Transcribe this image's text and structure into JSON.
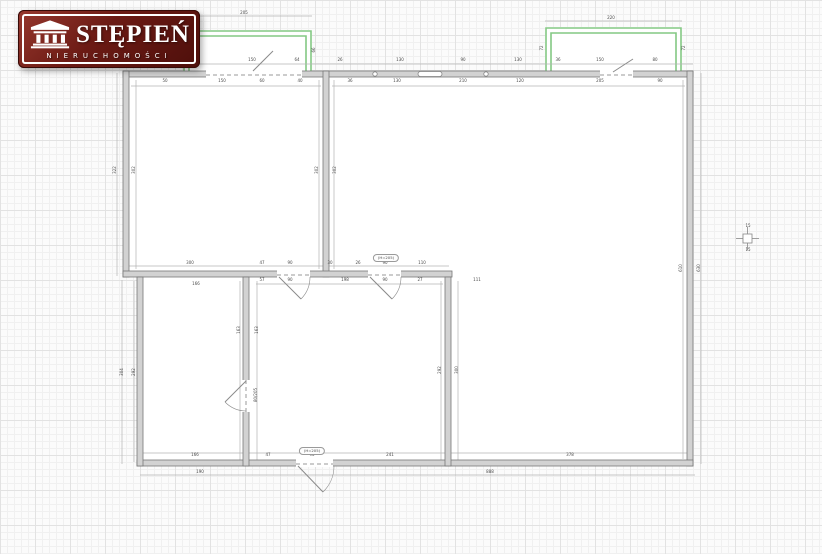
{
  "logo": {
    "title": "STĘPIEŃ",
    "subtitle": "NIERUCHOMOŚCI",
    "bg_color": "#6b1a14",
    "frame_color": "#ffffff",
    "icon": "portico-columns-icon"
  },
  "plan": {
    "wall_fill": "#d2d2d2",
    "wall_edge": "#777777",
    "balcony_color": "#84c884",
    "dim_line_color": "#b4b4b4",
    "annotations": [
      {
        "t": "(H=205)",
        "x": 386,
        "y": 258
      },
      {
        "t": "(H=205)",
        "x": 312,
        "y": 451
      }
    ],
    "door_labels": [
      {
        "t": "80/205",
        "x": 256,
        "y": 395
      }
    ],
    "dimension_labels": [
      {
        "t": "205",
        "x": 244,
        "y": 13
      },
      {
        "t": "66",
        "x": 179,
        "y": 50,
        "r": 1
      },
      {
        "t": "66",
        "x": 314,
        "y": 50,
        "r": 1
      },
      {
        "t": "220",
        "x": 611,
        "y": 18
      },
      {
        "t": "72",
        "x": 542,
        "y": 48,
        "r": 1
      },
      {
        "t": "72",
        "x": 684,
        "y": 48,
        "r": 1
      },
      {
        "t": "46",
        "x": 151,
        "y": 60
      },
      {
        "t": "30",
        "x": 196,
        "y": 60
      },
      {
        "t": "150",
        "x": 252,
        "y": 60
      },
      {
        "t": "64",
        "x": 297,
        "y": 60
      },
      {
        "t": "26",
        "x": 340,
        "y": 60
      },
      {
        "t": "130",
        "x": 400,
        "y": 60
      },
      {
        "t": "90",
        "x": 463,
        "y": 60
      },
      {
        "t": "130",
        "x": 518,
        "y": 60
      },
      {
        "t": "36",
        "x": 558,
        "y": 60
      },
      {
        "t": "150",
        "x": 600,
        "y": 60
      },
      {
        "t": "80",
        "x": 655,
        "y": 60
      },
      {
        "t": "50",
        "x": 165,
        "y": 81
      },
      {
        "t": "150",
        "x": 222,
        "y": 81
      },
      {
        "t": "60",
        "x": 262,
        "y": 81
      },
      {
        "t": "40",
        "x": 300,
        "y": 81
      },
      {
        "t": "36",
        "x": 350,
        "y": 81
      },
      {
        "t": "130",
        "x": 397,
        "y": 81
      },
      {
        "t": "210",
        "x": 463,
        "y": 81
      },
      {
        "t": "120",
        "x": 520,
        "y": 81
      },
      {
        "t": "205",
        "x": 600,
        "y": 81
      },
      {
        "t": "90",
        "x": 660,
        "y": 81
      },
      {
        "t": "322",
        "x": 115,
        "y": 170,
        "r": 1
      },
      {
        "t": "302",
        "x": 134,
        "y": 170,
        "r": 1
      },
      {
        "t": "302",
        "x": 317,
        "y": 170,
        "r": 1
      },
      {
        "t": "302",
        "x": 335,
        "y": 170,
        "r": 1
      },
      {
        "t": "610",
        "x": 681,
        "y": 268,
        "r": 1
      },
      {
        "t": "630",
        "x": 699,
        "y": 268,
        "r": 1
      },
      {
        "t": "300",
        "x": 190,
        "y": 263
      },
      {
        "t": "47",
        "x": 262,
        "y": 263
      },
      {
        "t": "90",
        "x": 290,
        "y": 263
      },
      {
        "t": "30",
        "x": 330,
        "y": 263
      },
      {
        "t": "26",
        "x": 358,
        "y": 263
      },
      {
        "t": "90",
        "x": 385,
        "y": 263
      },
      {
        "t": "110",
        "x": 422,
        "y": 263
      },
      {
        "t": "57",
        "x": 262,
        "y": 280
      },
      {
        "t": "90",
        "x": 290,
        "y": 280
      },
      {
        "t": "198",
        "x": 345,
        "y": 280
      },
      {
        "t": "90",
        "x": 385,
        "y": 280
      },
      {
        "t": "27",
        "x": 420,
        "y": 280
      },
      {
        "t": "111",
        "x": 477,
        "y": 280
      },
      {
        "t": "166",
        "x": 196,
        "y": 284
      },
      {
        "t": "304",
        "x": 122,
        "y": 372,
        "r": 1
      },
      {
        "t": "292",
        "x": 134,
        "y": 372,
        "r": 1
      },
      {
        "t": "163",
        "x": 239,
        "y": 330,
        "r": 1
      },
      {
        "t": "163",
        "x": 257,
        "y": 330,
        "r": 1
      },
      {
        "t": "292",
        "x": 440,
        "y": 370,
        "r": 1
      },
      {
        "t": "300",
        "x": 457,
        "y": 370,
        "r": 1
      },
      {
        "t": "166",
        "x": 195,
        "y": 455
      },
      {
        "t": "190",
        "x": 200,
        "y": 472
      },
      {
        "t": "47",
        "x": 268,
        "y": 455
      },
      {
        "t": "90",
        "x": 312,
        "y": 455
      },
      {
        "t": "241",
        "x": 390,
        "y": 455
      },
      {
        "t": "378",
        "x": 570,
        "y": 455
      },
      {
        "t": "888",
        "x": 490,
        "y": 472
      },
      {
        "t": "15",
        "x": 748,
        "y": 226
      },
      {
        "t": "15",
        "x": 748,
        "y": 250
      }
    ]
  }
}
